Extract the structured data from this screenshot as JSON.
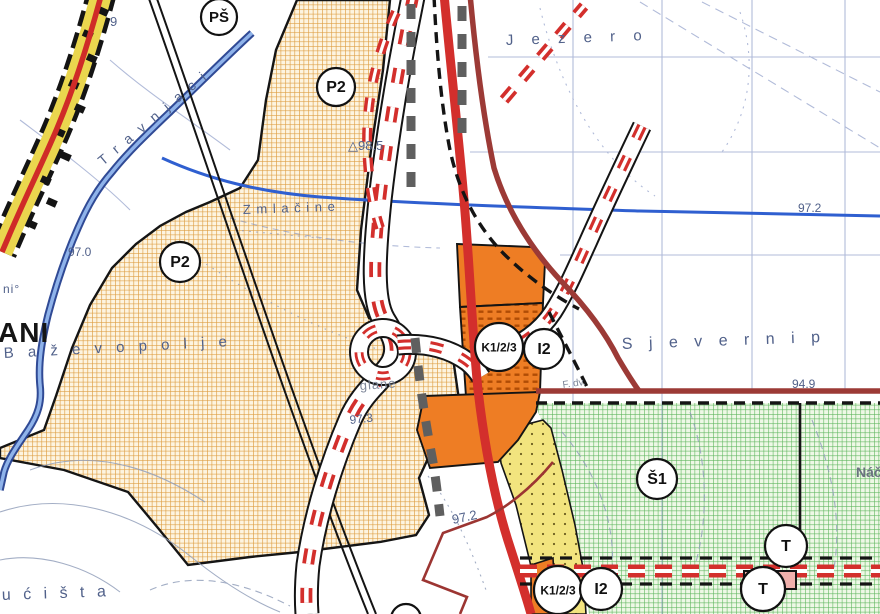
{
  "map": {
    "zone_circle_labels": [
      {
        "text": "PŠ",
        "x": 219,
        "y": 17,
        "r": 18,
        "fs": 15
      },
      {
        "text": "P2",
        "x": 336,
        "y": 87,
        "r": 19,
        "fs": 16
      },
      {
        "text": "P2",
        "x": 180,
        "y": 262,
        "r": 20,
        "fs": 16
      },
      {
        "text": "K1/2/3",
        "x": 499,
        "y": 347,
        "r": 24,
        "fs": 12
      },
      {
        "text": "I2",
        "x": 544,
        "y": 349,
        "r": 20,
        "fs": 16
      },
      {
        "text": "Š1",
        "x": 657,
        "y": 479,
        "r": 20,
        "fs": 16
      },
      {
        "text": "T",
        "x": 786,
        "y": 546,
        "r": 21,
        "fs": 16
      },
      {
        "text": "T",
        "x": 763,
        "y": 589,
        "r": 22,
        "fs": 16
      },
      {
        "text": "K1/2/3",
        "x": 558,
        "y": 590,
        "r": 24,
        "fs": 12
      },
      {
        "text": "I2",
        "x": 601,
        "y": 589,
        "r": 21,
        "fs": 16
      },
      {
        "text": "✕",
        "x": 406,
        "y": 619,
        "r": 15,
        "fs": 12
      }
    ],
    "place_names": [
      {
        "text": "J e z e r o",
        "x": 506,
        "y": 45,
        "size": 15,
        "spacing": 7,
        "rotate": -2
      },
      {
        "text": "T r a v n j a c i",
        "x": 103,
        "y": 166,
        "size": 14,
        "spacing": 3,
        "rotate": -40
      },
      {
        "text": "Z m l a č i n e",
        "x": 243,
        "y": 214,
        "size": 13,
        "spacing": 1,
        "rotate": -2
      },
      {
        "text": "B a ž e v o   p o l j e",
        "x": 4,
        "y": 358,
        "size": 15,
        "spacing": 5,
        "rotate": -3
      },
      {
        "text": "S j e v e r n i   p",
        "x": 622,
        "y": 349,
        "size": 16,
        "spacing": 6,
        "rotate": -2
      },
      {
        "text": "u ć i š t a",
        "x": 2,
        "y": 600,
        "size": 16,
        "spacing": 4,
        "rotate": -2
      },
      {
        "text": "glane",
        "x": 360,
        "y": 390,
        "size": 13,
        "spacing": 1,
        "rotate": -4,
        "color": "#7d8698"
      },
      {
        "text": "F. dv.",
        "x": 563,
        "y": 388,
        "size": 10,
        "spacing": 0,
        "rotate": -8,
        "color": "#7d8698"
      },
      {
        "text": "Náč",
        "x": 856,
        "y": 477,
        "size": 14,
        "spacing": 0,
        "color": "#6b7280",
        "bold": true
      },
      {
        "text": "ni°",
        "x": 3,
        "y": 293,
        "size": 12,
        "spacing": 1
      },
      {
        "text": "9",
        "x": 110,
        "y": 26,
        "size": 13
      },
      {
        "text": "ANI",
        "x": -2,
        "y": 342,
        "size": 28,
        "spacing": 1,
        "bold": true,
        "color": "#151515"
      }
    ],
    "elevation_points": [
      {
        "text": "△98.5",
        "x": 348,
        "y": 150,
        "size": 13
      },
      {
        "text": "97.0",
        "x": 68,
        "y": 256,
        "size": 12
      },
      {
        "text": "97.3",
        "x": 350,
        "y": 424,
        "size": 12,
        "rotate": -6
      },
      {
        "text": "97.2",
        "x": 798,
        "y": 212,
        "size": 12
      },
      {
        "text": "97.2",
        "x": 453,
        "y": 524,
        "size": 13,
        "rotate": -12
      },
      {
        "text": "94.9",
        "x": 792,
        "y": 388,
        "size": 12
      }
    ],
    "colors": {
      "agriculture_hatch_orange": "#dd9c3f",
      "sport_hatch_green": "#5cb55c",
      "industrial_fill_orange": "#ee7d24",
      "mixed_strip_yellow": "#f2e47e",
      "settlement_yellow": "#ead64e",
      "state_road_red": "#d32f2c",
      "secondary_road_maroon": "#9c3a36",
      "planned_road_dash_red": "#d32f2c",
      "railway_black": "#141414",
      "river_blue_dark": "#25408f",
      "river_blue_light": "#8fb3ea",
      "stream_blue": "#2f5fd0",
      "cadastral_blue": "#7e8fc0",
      "toponym_gray_blue": "#51618a"
    }
  }
}
